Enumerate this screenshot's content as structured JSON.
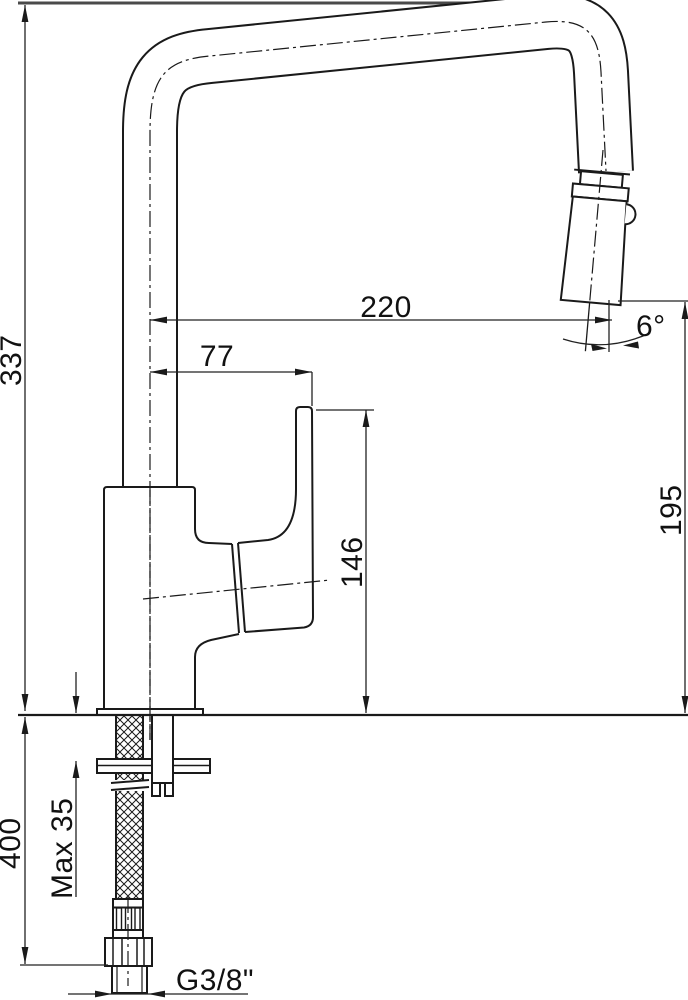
{
  "title": "Kitchen faucet dimensional drawing",
  "dimensions": {
    "overall_height": "337",
    "spout_reach": "220",
    "handle_offset": "77",
    "outlet_angle": "6°",
    "outlet_height": "195",
    "body_height": "146",
    "hose_length": "400",
    "max_counter_thickness": "Max 35",
    "connection_thread": "G3/8\""
  },
  "colors": {
    "line": "#1a1a1a",
    "dimension_line": "#222222",
    "top_reference_line": "#4a4a4a",
    "background": "#ffffff"
  }
}
